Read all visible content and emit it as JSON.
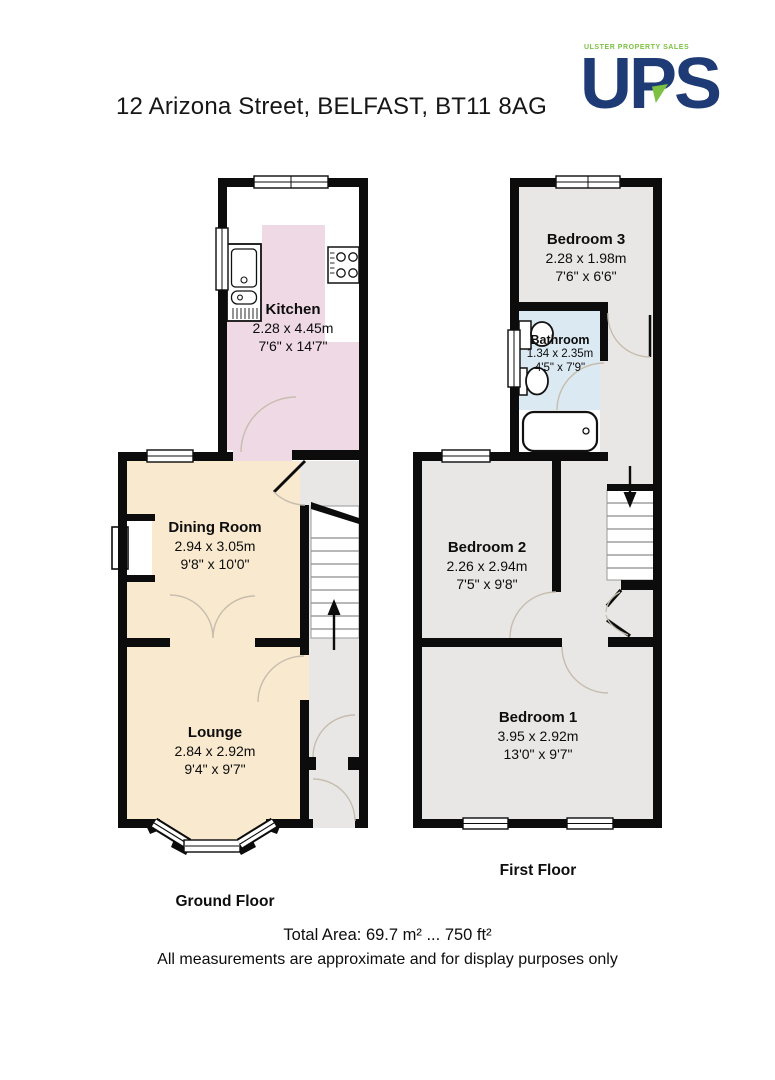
{
  "header": {
    "title": "12 Arizona Street, BELFAST, BT11 8AG",
    "logo": {
      "tagline": "ULSTER PROPERTY SALES",
      "name": "UPS",
      "navy": "#1e3b76",
      "green": "#7cc142"
    }
  },
  "floors": {
    "ground": {
      "label": "Ground Floor",
      "rooms": {
        "kitchen": {
          "name": "Kitchen",
          "metric": "2.28 x 4.45m",
          "imperial": "7'6\" x 14'7\""
        },
        "dining": {
          "name": "Dining Room",
          "metric": "2.94 x 3.05m",
          "imperial": "9'8\" x 10'0\""
        },
        "lounge": {
          "name": "Lounge",
          "metric": "2.84 x 2.92m",
          "imperial": "9'4\" x 9'7\""
        }
      }
    },
    "first": {
      "label": "First Floor",
      "rooms": {
        "bedroom3": {
          "name": "Bedroom 3",
          "metric": "2.28 x 1.98m",
          "imperial": "7'6\" x 6'6\""
        },
        "bathroom": {
          "name": "Bathroom",
          "metric": "1.34 x 2.35m",
          "imperial": "4'5\" x 7'9\""
        },
        "bedroom2": {
          "name": "Bedroom 2",
          "metric": "2.26 x 2.94m",
          "imperial": "7'5\" x 9'8\""
        },
        "bedroom1": {
          "name": "Bedroom 1",
          "metric": "3.95 x 2.92m",
          "imperial": "13'0\" x 9'7\""
        }
      }
    }
  },
  "footer": {
    "total_area": "Total Area: 69.7 m² ... 750 ft²",
    "disclaimer": "All measurements are approximate and for display purposes only"
  },
  "colors": {
    "wall": "#0c0c0c",
    "kitchen_floor": "#eed9e4",
    "reception_floor": "#f8e9cf",
    "hall_bedroom_floor": "#e8e7e6",
    "bathroom_floor": "#dbe9f2",
    "door_arc": "#c7bdae"
  },
  "icons": {
    "stairs_up": "up-arrow",
    "stairs_down": "down-arrow"
  }
}
